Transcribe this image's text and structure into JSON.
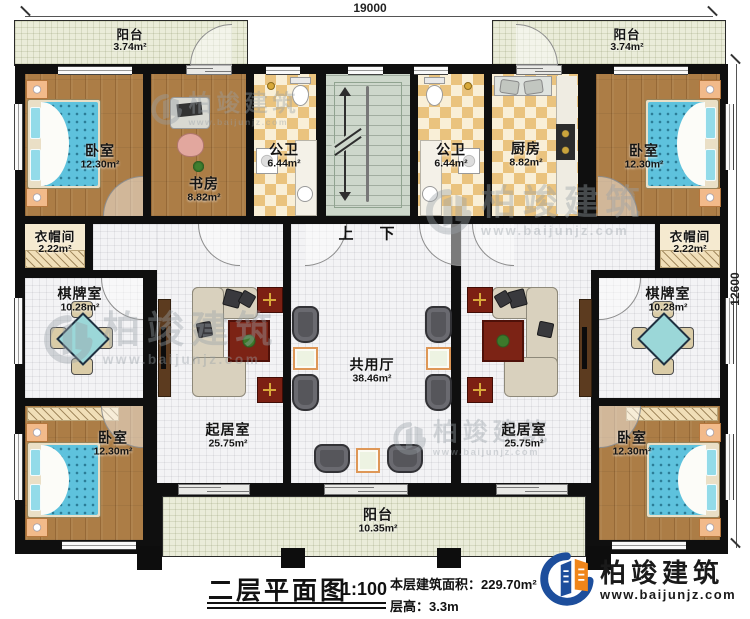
{
  "dimensions": {
    "top": "19000",
    "right": "12600"
  },
  "rooms": {
    "balcony_tl": {
      "name": "阳台",
      "area": "3.74m²"
    },
    "balcony_tr": {
      "name": "阳台",
      "area": "3.74m²"
    },
    "bedroom_tl": {
      "name": "卧室",
      "area": "12.30m²"
    },
    "study": {
      "name": "书房",
      "area": "8.82m²"
    },
    "bath_left": {
      "name": "公卫",
      "area": "6.44m²"
    },
    "bath_right": {
      "name": "公卫",
      "area": "6.44m²"
    },
    "kitchen": {
      "name": "厨房",
      "area": "8.82m²"
    },
    "bedroom_tr": {
      "name": "卧室",
      "area": "12.30m²"
    },
    "closet_left": {
      "name": "衣帽间",
      "area": "2.22m²"
    },
    "closet_right": {
      "name": "衣帽间",
      "area": "2.22m²"
    },
    "chess_left": {
      "name": "棋牌室",
      "area": "10.28m²"
    },
    "chess_right": {
      "name": "棋牌室",
      "area": "10.28m²"
    },
    "living_left": {
      "name": "起居室",
      "area": "25.75m²"
    },
    "living_right": {
      "name": "起居室",
      "area": "25.75m²"
    },
    "hall": {
      "name": "共用厅",
      "area": "38.46m²"
    },
    "bedroom_bl": {
      "name": "卧室",
      "area": "12.30m²"
    },
    "bedroom_br": {
      "name": "卧室",
      "area": "12.30m²"
    },
    "balcony_bottom": {
      "name": "阳台",
      "area": "10.35m²"
    }
  },
  "stairs": {
    "up": "上",
    "down": "下"
  },
  "title_block": {
    "title": "二层平面图",
    "scale": "1:100",
    "area_line": "本层建筑面积：229.70m²",
    "floor_height_line": "层高：3.3m"
  },
  "logo": {
    "name": "柏竣建筑",
    "url": "www.baijunjz.com"
  },
  "watermark": {
    "name": "柏竣建筑",
    "url": "www.baijunjz.com"
  },
  "colors": {
    "wall": "#0f0f0f",
    "wood_floor": "#ac7d46",
    "checker_tile": "#eac37e",
    "tile_floor": "#f3f3f5",
    "balcony_floor": "#eaecd9",
    "stair_floor": "#cdd7cb",
    "bed_blue": "#5ec2dd",
    "logo_blue": "#1d4e9c",
    "logo_orange": "#f08519"
  }
}
